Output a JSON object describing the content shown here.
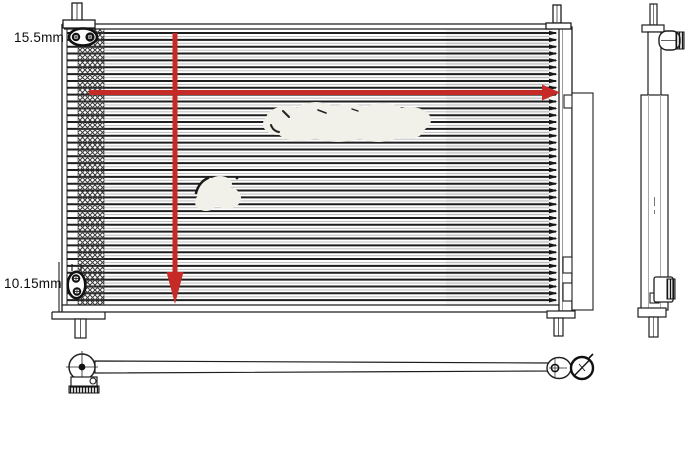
{
  "annotations": {
    "fin_height_label": "15.5mm",
    "tube_height_label": "10.15mm",
    "width_arrow_direction": "right",
    "height_arrow_direction": "down"
  },
  "colors": {
    "annotation_red": "#c52a26",
    "line_dark": "#1e1e1e",
    "line_light": "#c2c2c2",
    "watermark": "#f1f0e9",
    "background": "#ffffff"
  }
}
